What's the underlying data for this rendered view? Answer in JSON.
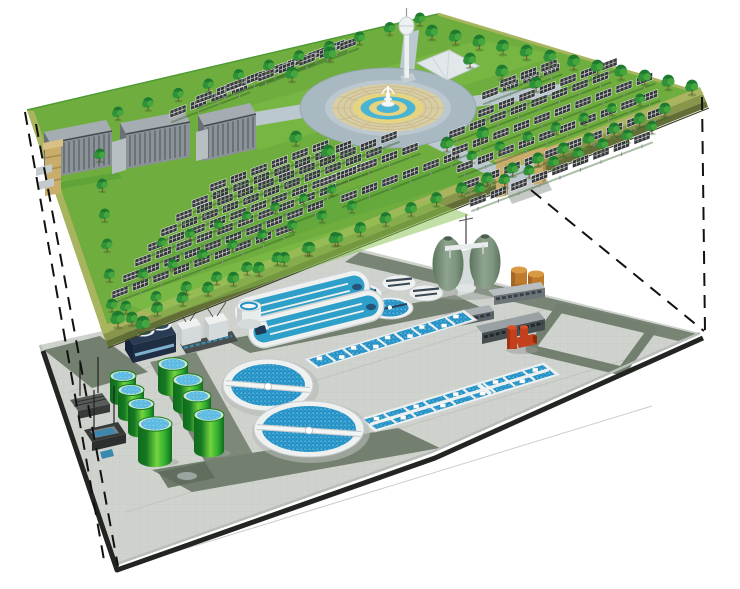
{
  "scene": {
    "alt": "Exploded axonometric illustration of a landscaped solar park deck above an underground wastewater treatment plant, connected by dashed projection lines",
    "upper_level": {
      "name": "solar-park-deck",
      "label": "Solar park with central fountain plaza",
      "components": [
        {
          "name": "solar-panel",
          "quantity": 170
        },
        {
          "name": "tree",
          "quantity": 110
        },
        {
          "name": "fountain-plaza",
          "quantity": 1
        },
        {
          "name": "observation-tower",
          "quantity": 1
        },
        {
          "name": "event-canopy",
          "quantity": 1
        },
        {
          "name": "louvered-building",
          "quantity": 3
        },
        {
          "name": "entrance-gate",
          "quantity": 2
        }
      ]
    },
    "lower_level": {
      "name": "wastewater-treatment-plant",
      "label": "Underground wastewater treatment works",
      "components": [
        {
          "name": "large-circular-clarifier",
          "quantity": 2
        },
        {
          "name": "small-circular-clarifier",
          "quantity": 2
        },
        {
          "name": "covered-round-tank",
          "quantity": 2
        },
        {
          "name": "oxidation-ditch",
          "quantity": 2
        },
        {
          "name": "aeration-basin-block",
          "quantity": 2
        },
        {
          "name": "green-sludge-tank",
          "quantity": 8
        },
        {
          "name": "egg-shaped-digester",
          "quantity": 2
        },
        {
          "name": "orange-storage-tank",
          "quantity": 2
        },
        {
          "name": "process-building",
          "quantity": 4
        },
        {
          "name": "red-pump-unit",
          "quantity": 1
        },
        {
          "name": "inlet-screen",
          "quantity": 2
        },
        {
          "name": "white-silo",
          "quantity": 1
        }
      ]
    },
    "projection": {
      "style": "dashed",
      "line_count": 4
    }
  },
  "palette": {
    "background": "#ffffff",
    "projection_line": "#111111",
    "park": {
      "grass": "#6fae3e",
      "grass_light": "#85c24c",
      "grass_dark": "#4f9a34",
      "border_top": "#a9b45e",
      "border_side": "#87964a",
      "border_side_dark": "#616e35",
      "edge_line": "#3c4128",
      "tree_dark": "#1d7a2e",
      "tree_mid": "#2f9138",
      "tree_light": "#49a93f",
      "trunk": "#7a5c33",
      "panel": "#35383b",
      "panel_grid": "#e8eaea",
      "panel_post": "#8a9096",
      "building_roof": "#a5adb2",
      "building_front": "#8b9298",
      "building_stripe": "#565c62",
      "building_side": "#6a7076",
      "plaza_road": "#a9b9c2",
      "plaza_road_light": "#bcc8cf",
      "plaza_pave": "#d9cda3",
      "plaza_pave_line": "#c3b489",
      "ring_yellow": "#e6d57e",
      "ring_blue": "#49b4d4",
      "fountain_white": "#f4f7f7",
      "tower": "#eef1f2",
      "tower_shade": "#c3cdd2",
      "canopy": "#e2e8ea",
      "gate": "#c9ad6b",
      "gate_dark": "#a78a4e"
    },
    "plant": {
      "pavement": "#cfd2cd",
      "pavement_grid": "#b9bdb7",
      "road": "#73806f",
      "road_dark": "#5e6b5c",
      "edge_curb": "#b9beba",
      "edge_dark": "#232522",
      "unit_white": "#eef1f0",
      "unit_white_shade": "#c9cfd1",
      "water_blue": "#2492c6",
      "water_blue_light": "#5cb9e2",
      "navy": "#2a3c55",
      "navy_dark": "#1f2e42",
      "navy_window": "#7fb0cf",
      "tank_green_dark": "#157a22",
      "tank_green": "#2fae2e",
      "tank_green_light": "#74d43f",
      "egg_green": "#7e957f",
      "egg_green_dark": "#5d755f",
      "orange_tank": "#c07a2e",
      "orange_tank_light": "#d89a44",
      "orange_tank_dark": "#8f5520",
      "red_equipment": "#c2401c",
      "red_equipment_dark": "#8e2c10",
      "screen_gray": "#585d5a",
      "screen_dark": "#363a38",
      "screen_blue": "#3a88b0"
    }
  }
}
